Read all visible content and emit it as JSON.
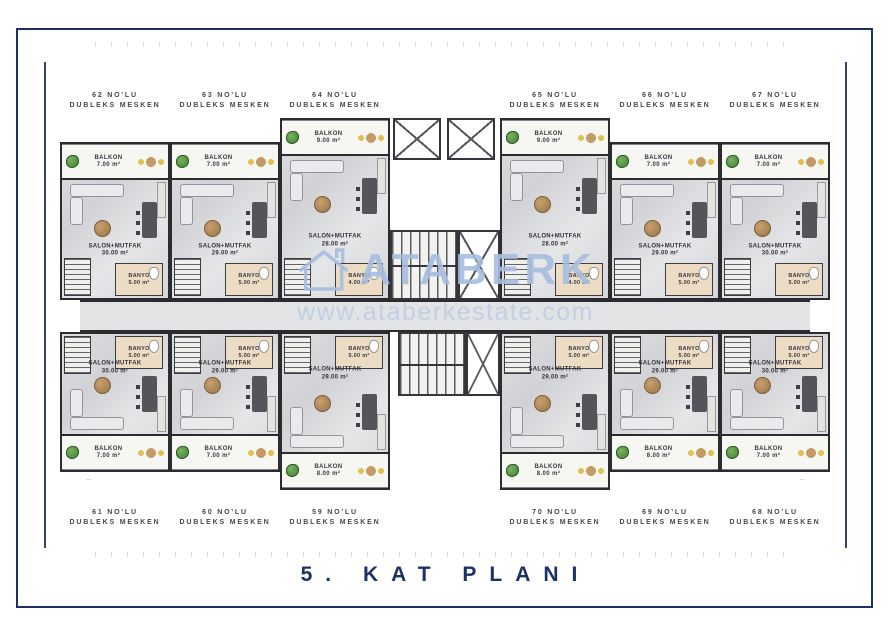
{
  "title": "5. KAT PLANI",
  "watermark": {
    "brand": "ATABERK",
    "url": "www.ataberkestate.com"
  },
  "colors": {
    "frame_navy": "#1e2f63",
    "title_navy": "#1d3166",
    "watermark_blue": "#a7bddf",
    "wall": "#2b2b30",
    "floor_gray": "#d8d9db",
    "banyo_beige": "#ecdcc4",
    "corridor_gray": "#e2e3e5",
    "plant_green": "#4c8a3f",
    "table_tan": "#c49a66"
  },
  "units_top": [
    {
      "no": "62 NO'LU",
      "type": "DUBLEKS MESKEN",
      "salon": "SALON+MUTFAK",
      "salon_area": "30.00 m²",
      "banyo": "BANYO",
      "banyo_area": "5.00 m²",
      "balkon": "BALKON",
      "balkon_area": "7.00 m²"
    },
    {
      "no": "63 NO'LU",
      "type": "DUBLEKS MESKEN",
      "salon": "SALON+MUTFAK",
      "salon_area": "29.00 m²",
      "banyo": "BANYO",
      "banyo_area": "5.00 m²",
      "balkon": "BALKON",
      "balkon_area": "7.00 m²"
    },
    {
      "no": "64 NO'LU",
      "type": "DUBLEKS MESKEN",
      "salon": "SALON+MUTFAK",
      "salon_area": "28.00 m²",
      "banyo": "BANYO",
      "banyo_area": "4.00 m²",
      "balkon": "BALKON",
      "balkon_area": "9.00 m²"
    },
    {
      "no": "65 NO'LU",
      "type": "DUBLEKS MESKEN",
      "salon": "SALON+MUTFAK",
      "salon_area": "28.00 m²",
      "banyo": "BANYO",
      "banyo_area": "4.00 m²",
      "balkon": "BALKON",
      "balkon_area": "9.00 m²"
    },
    {
      "no": "66 NO'LU",
      "type": "DUBLEKS MESKEN",
      "salon": "SALON+MUTFAK",
      "salon_area": "29.00 m²",
      "banyo": "BANYO",
      "banyo_area": "5.00 m²",
      "balkon": "BALKON",
      "balkon_area": "7.00 m²"
    },
    {
      "no": "67 NO'LU",
      "type": "DUBLEKS MESKEN",
      "salon": "SALON+MUTFAK",
      "salon_area": "30.00 m²",
      "banyo": "BANYO",
      "banyo_area": "5.00 m²",
      "balkon": "BALKON",
      "balkon_area": "7.00 m²"
    }
  ],
  "units_bottom": [
    {
      "no": "61 NO'LU",
      "type": "DUBLEKS MESKEN",
      "salon": "SALON+MUTFAK",
      "salon_area": "30.00 m²",
      "banyo": "BANYO",
      "banyo_area": "5.00 m²",
      "balkon": "BALKON",
      "balkon_area": "7.00 m²"
    },
    {
      "no": "60 NO'LU",
      "type": "DUBLEKS MESKEN",
      "salon": "SALON+MUTFAK",
      "salon_area": "29.00 m²",
      "banyo": "BANYO",
      "banyo_area": "5.00 m²",
      "balkon": "BALKON",
      "balkon_area": "7.00 m²"
    },
    {
      "no": "59 NO'LU",
      "type": "DUBLEKS MESKEN",
      "salon": "SALON+MUTFAK",
      "salon_area": "29.00 m²",
      "banyo": "BANYO",
      "banyo_area": "5.00 m²",
      "balkon": "BALKON",
      "balkon_area": "8.00 m²"
    },
    {
      "no": "70 NO'LU",
      "type": "DUBLEKS MESKEN",
      "salon": "SALON+MUTFAK",
      "salon_area": "29.00 m²",
      "banyo": "BANYO",
      "banyo_area": "5.00 m²",
      "balkon": "BALKON",
      "balkon_area": "8.00 m²"
    },
    {
      "no": "69 NO'LU",
      "type": "DUBLEKS MESKEN",
      "salon": "SALON+MUTFAK",
      "salon_area": "29.00 m²",
      "banyo": "BANYO",
      "banyo_area": "5.00 m²",
      "balkon": "BALKON",
      "balkon_area": "8.00 m²"
    },
    {
      "no": "68 NO'LU",
      "type": "DUBLEKS MESKEN",
      "salon": "SALON+MUTFAK",
      "salon_area": "30.00 m²",
      "banyo": "BANYO",
      "banyo_area": "5.00 m²",
      "balkon": "BALKON",
      "balkon_area": "7.00 m²"
    }
  ]
}
